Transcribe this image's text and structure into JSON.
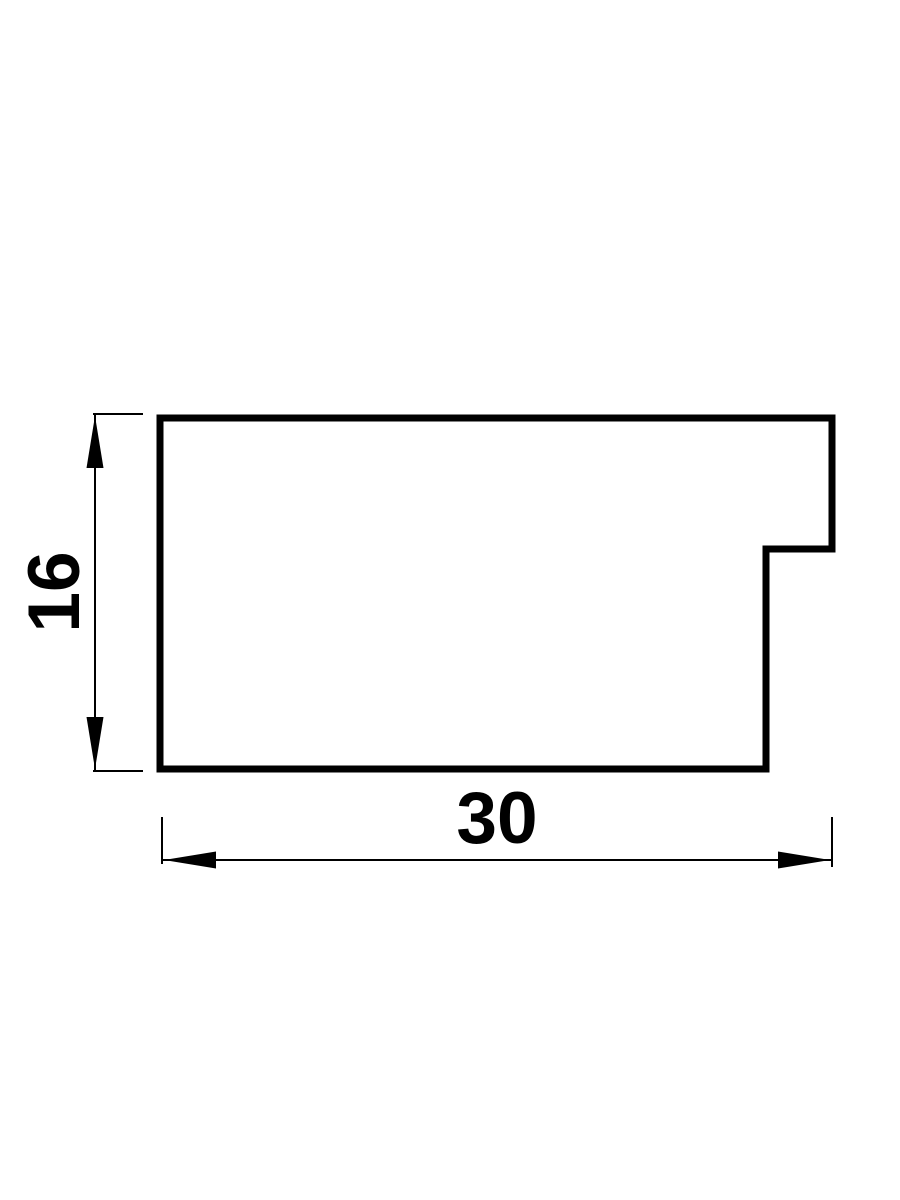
{
  "drawing": {
    "colors": {
      "stroke": "#000000",
      "background": "#ffffff"
    },
    "dimensions": {
      "height": {
        "label": "16",
        "orientation": "vertical"
      },
      "width": {
        "label": "30",
        "orientation": "horizontal"
      }
    }
  }
}
